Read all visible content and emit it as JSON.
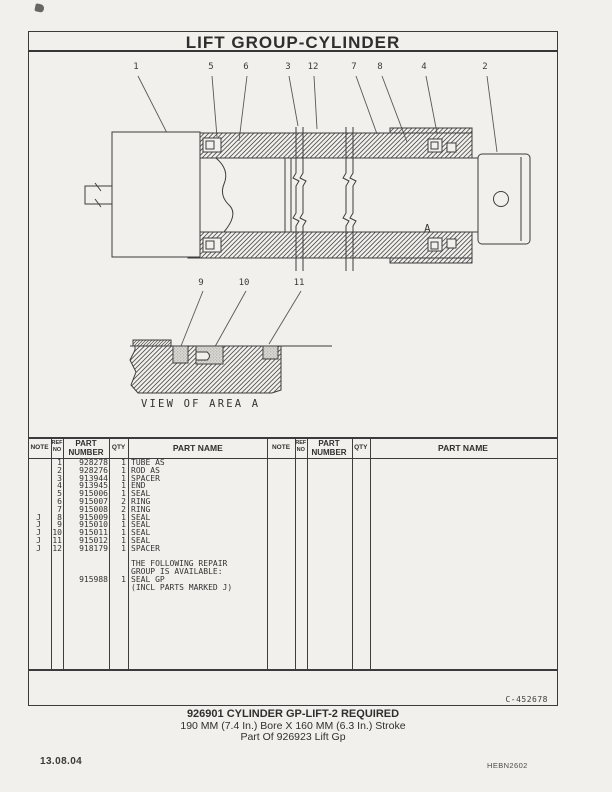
{
  "page": {
    "title": "LIFT GROUP-CYLINDER",
    "doc_number": "C-452678",
    "date": "13.08.04",
    "form_code": "HEBN2602"
  },
  "diagram": {
    "callouts_main": [
      "1",
      "5",
      "6",
      "3",
      "12",
      "7",
      "8",
      "4",
      "2"
    ],
    "callouts_area": [
      "9",
      "10",
      "11"
    ],
    "area_marker": "A",
    "area_caption": "VIEW OF AREA A"
  },
  "table": {
    "headers": {
      "note": "NOTE",
      "ref_line1": "REF",
      "ref_line2": "NO",
      "part_line1": "PART",
      "part_line2": "NUMBER",
      "qty": "QTY",
      "name": "PART NAME"
    },
    "rows": [
      {
        "note": "",
        "ref": "1",
        "part": "928278",
        "qty": "1",
        "name": "TUBE AS"
      },
      {
        "note": "",
        "ref": "2",
        "part": "928276",
        "qty": "1",
        "name": "ROD AS"
      },
      {
        "note": "",
        "ref": "3",
        "part": "913944",
        "qty": "1",
        "name": "SPACER"
      },
      {
        "note": "",
        "ref": "4",
        "part": "913945",
        "qty": "1",
        "name": "END"
      },
      {
        "note": "",
        "ref": "5",
        "part": "915006",
        "qty": "1",
        "name": "SEAL"
      },
      {
        "note": "",
        "ref": "6",
        "part": "915007",
        "qty": "2",
        "name": "RING"
      },
      {
        "note": "",
        "ref": "7",
        "part": "915008",
        "qty": "2",
        "name": "RING"
      },
      {
        "note": "J",
        "ref": "8",
        "part": "915009",
        "qty": "1",
        "name": "SEAL"
      },
      {
        "note": "J",
        "ref": "9",
        "part": "915010",
        "qty": "1",
        "name": "SEAL"
      },
      {
        "note": "J",
        "ref": "10",
        "part": "915011",
        "qty": "1",
        "name": "SEAL"
      },
      {
        "note": "J",
        "ref": "11",
        "part": "915012",
        "qty": "1",
        "name": "SEAL"
      },
      {
        "note": "J",
        "ref": "12",
        "part": "918179",
        "qty": "1",
        "name": "SPACER"
      },
      {
        "note": "",
        "ref": "",
        "part": "",
        "qty": "",
        "name": ""
      },
      {
        "note": "",
        "ref": "",
        "part": "",
        "qty": "",
        "name": "THE FOLLOWING REPAIR"
      },
      {
        "note": "",
        "ref": "",
        "part": "",
        "qty": "",
        "name": "GROUP IS AVAILABLE:"
      },
      {
        "note": "",
        "ref": "",
        "part": "915988",
        "qty": "1",
        "name": "SEAL GP"
      },
      {
        "note": "",
        "ref": "",
        "part": "",
        "qty": "",
        "name": "(INCL PARTS MARKED J)"
      }
    ]
  },
  "caption": {
    "line1": "926901 CYLINDER GP-LIFT-2 REQUIRED",
    "line2": "190 MM (7.4 In.) Bore X 160 MM (6.3 In.) Stroke",
    "line3": "Part Of 926923 Lift Gp"
  },
  "colors": {
    "paper": "#f1f0ec",
    "ink": "#3b3b3b"
  }
}
